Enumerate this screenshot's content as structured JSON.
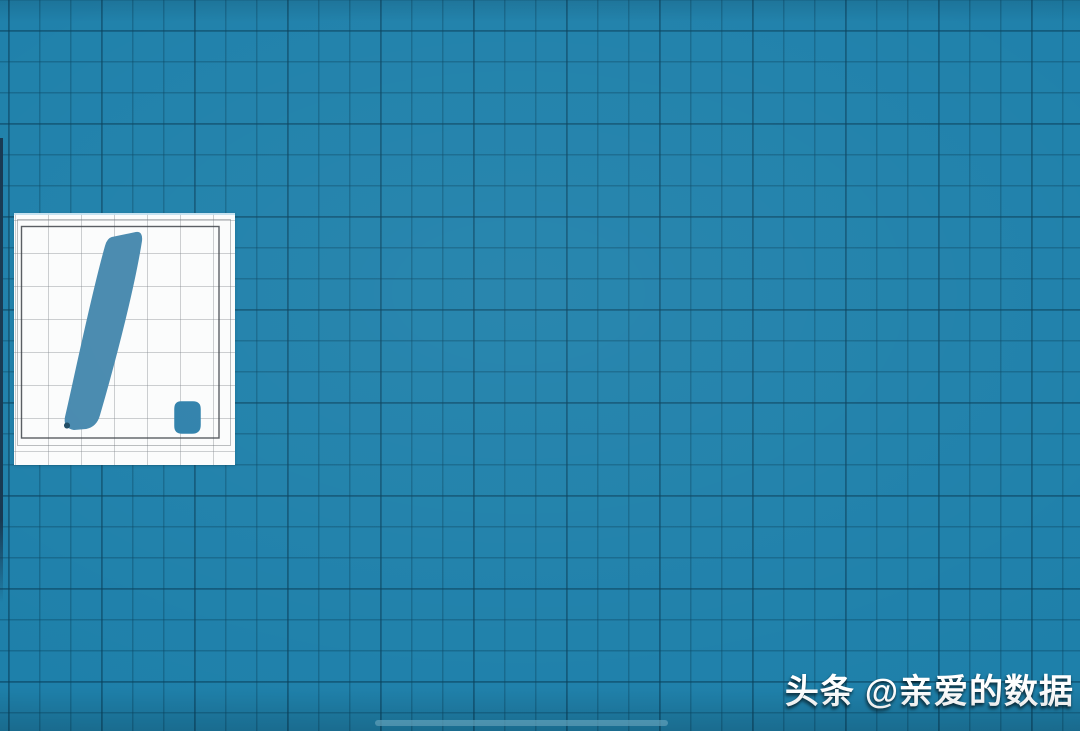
{
  "theme": {
    "background": "#1E80AA",
    "grid_line": "rgba(9,70,99,0.40)",
    "grid_line_strong": "rgba(7,58,84,0.30)",
    "card_bg": "#FBFCFC",
    "card_grid": "rgba(128,134,140,0.40)",
    "card_border": "rgba(58,62,68,0.85)",
    "card_border_faint": "rgba(105,110,116,0.45)",
    "ink": "#4789AE",
    "ink_dark": "#2F81AB",
    "ink_blot": "#1D4A63",
    "left_edge": "#153750",
    "home_indicator": "rgba(105,180,210,0.75)",
    "watermark_color": "#FFFFFF"
  },
  "canvas": {
    "kind": "grid whiteboard canvas",
    "grid_spacing_px": 31
  },
  "note_card": {
    "kind": "handwritten note card",
    "written_glyph": "1.",
    "stroke_path": "M98,25 L122,20 Q128,19 127,28 C120,72 103,140 85,202 Q82,213 72,215 L60,216 Q50,214 52,204 C60,170 78,82 92,33 Q94,26 98,25 Z",
    "dot_path": "M167,189 L179,189 Q186,189 186,196 L186,212 Q186,220 178,220 L168,220 Q161,220 161,213 L161,196 Q161,189 167,189 Z",
    "blot_path": "M50,212 a3,3 0 1 0 6,1 a3,3 0 1 0 -6,-1 Z"
  },
  "watermark": {
    "platform": "头条",
    "handle": "@亲爱的数据"
  }
}
